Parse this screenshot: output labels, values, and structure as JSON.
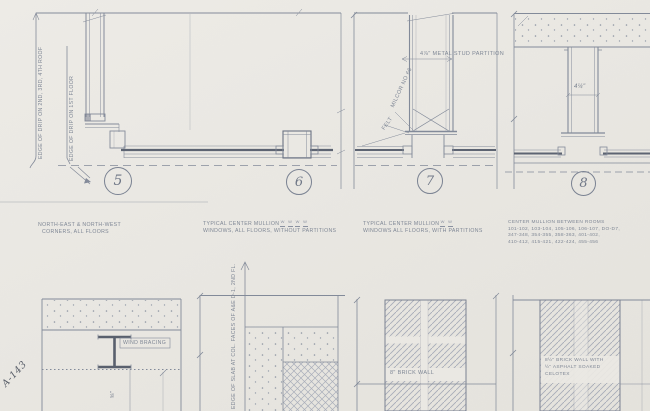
{
  "sheet": {
    "handwritten_id": "A-143",
    "details_top": [
      {
        "number": "5",
        "caption": [
          "NORTH-EAST & NORTH-WEST",
          "CORNERS, ALL FLOORS"
        ],
        "label_drip_roof": "EDGE OF DRIP ON 2ND, 3RD, 4TH ROOF",
        "label_drip_first": "EDGE OF DRIP ON 1ST FLOOR"
      },
      {
        "number": "6",
        "caption": [
          "TYPICAL CENTER MULLION",
          "WINDOWS, ALL FLOORS, WITHOUT PARTITIONS"
        ],
        "window_marks": [
          "W",
          "W",
          "W",
          "W"
        ]
      },
      {
        "number": "7",
        "caption": [
          "TYPICAL CENTER MULLION",
          "WINDOWS ALL FLOORS, WITH PARTITIONS"
        ],
        "window_marks": [
          "W",
          "W"
        ],
        "label_partition": "4⅞\" METAL STUD PARTITION",
        "label_felt": "FELT",
        "label_milcor": "MILCOR NO 66"
      },
      {
        "number": "8",
        "caption": [
          "CENTER MULLION BETWEEN ROOMS",
          "101-102, 103-104, 105-106, 106-107, DO-D7,",
          "347-348, 354-355, 358-363, 401-402,",
          "410-412, 415-421, 422-424, 455-456"
        ],
        "label_dim": "4¼\""
      }
    ],
    "details_bottom": [
      {
        "label_wind_bracing": "WIND BRACING",
        "label_dim": "⅝\""
      },
      {
        "label_edge_of_slab": "EDGE OF SLAB AT COL. FACES OF A&E D-1, 2ND FL."
      },
      {
        "label_wall": "8\" BRICK WALL"
      },
      {
        "label_wall_lines": [
          "8½\" BRICK WALL WITH",
          "½\" ASPHALT SOAKED",
          "CELOTEX"
        ]
      }
    ]
  }
}
